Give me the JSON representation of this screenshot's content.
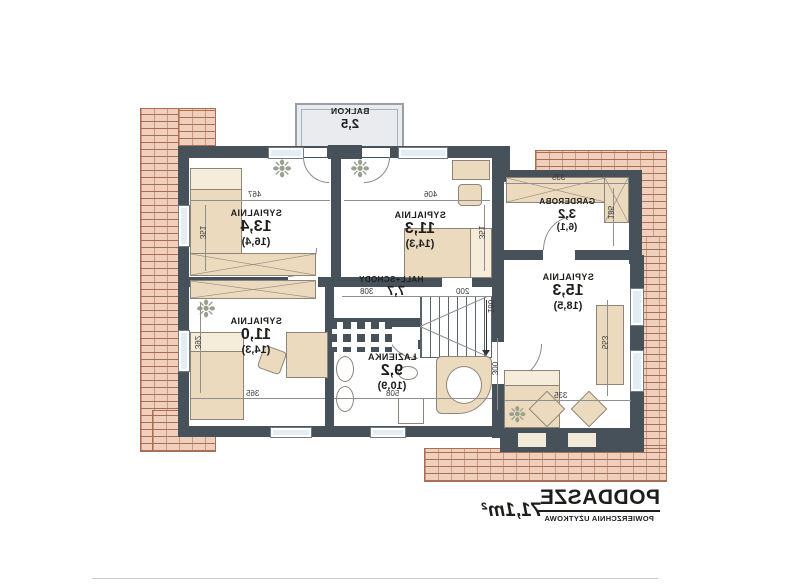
{
  "title_block": {
    "title": "PODDASZE",
    "subtitle": "POWIERZCHNIA UŻYTKOWA",
    "area": "71,1m²"
  },
  "balcony": {
    "name": "BALKON",
    "area": "2,5"
  },
  "rooms": [
    {
      "name": "SYPIALNIA",
      "area": "13,4",
      "floor_area": "(16,4)"
    },
    {
      "name": "SYPIALNIA",
      "area": "11,3",
      "floor_area": "(14,3)"
    },
    {
      "name": "GARDEROBA",
      "area": "3,2",
      "floor_area": "(6,1)"
    },
    {
      "name": "SYPIALNIA",
      "area": "15,3",
      "floor_area": "(18,5)"
    },
    {
      "name": "SYPIALNIA",
      "area": "11,0",
      "floor_area": "(14,3)"
    },
    {
      "name": "ŁAZIENKA",
      "area": "9,2",
      "floor_area": "(10,9)"
    },
    {
      "name": "HALL+SCHODY",
      "area": "7,7"
    }
  ],
  "dims": {
    "w_left": "467",
    "w_mid": "406",
    "w_gard": "335",
    "h_left_up": "351",
    "h_mid_up": "351",
    "h_gard": "185",
    "h_right": "553",
    "w_right_bottom": "335",
    "h_mid_low": "300",
    "h_left_low": "392",
    "w_left_bottom": "365",
    "w_bath": "508",
    "w_stairs": "200",
    "h_stairs": "180",
    "w_hall": "308"
  },
  "icons": {
    "plant": "❉"
  },
  "colors": {
    "wall": "#47515a",
    "furniture": "#ecdabf",
    "brick": "#f0d0bd",
    "brick_line": "#a96f56",
    "window": "#e3edf3",
    "text": "#1d1d1b"
  }
}
